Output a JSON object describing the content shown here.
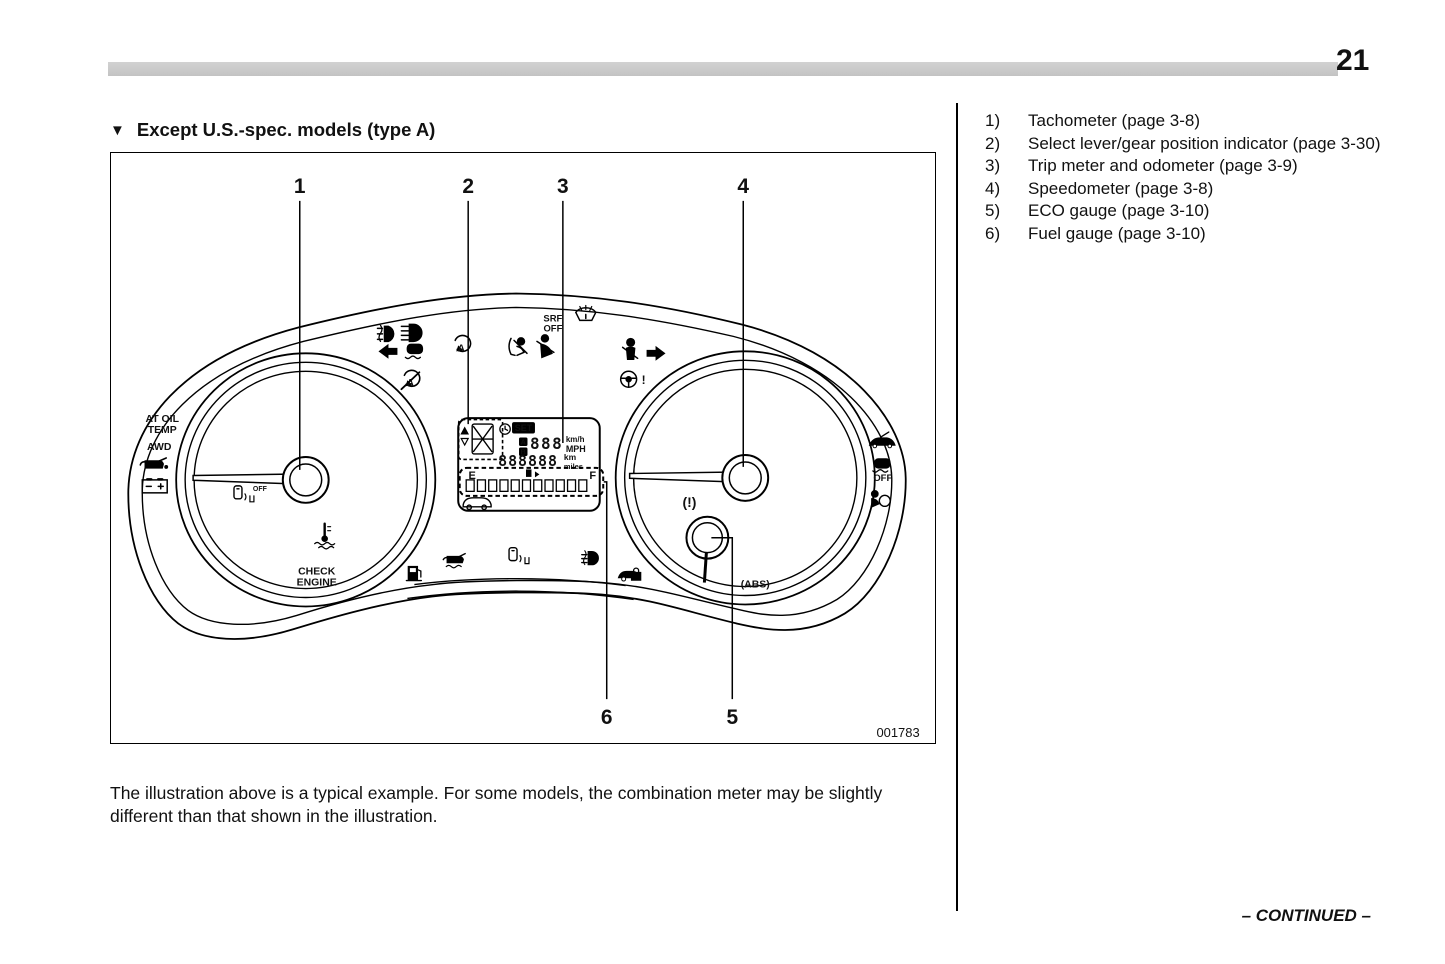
{
  "page": {
    "number": "21",
    "continued_label": "– CONTINUED –"
  },
  "heading": {
    "marker": "▼",
    "title": "Except U.S.-spec. models (type A)"
  },
  "legend": {
    "items": [
      {
        "num": "1)",
        "label": "Tachometer (page 3-8)"
      },
      {
        "num": "2)",
        "label": "Select lever/gear position indicator (page 3-30)"
      },
      {
        "num": "3)",
        "label": "Trip meter and odometer (page 3-9)"
      },
      {
        "num": "4)",
        "label": "Speedometer (page 3-8)"
      },
      {
        "num": "5)",
        "label": "ECO gauge (page 3-10)"
      },
      {
        "num": "6)",
        "label": "Fuel gauge (page 3-10)"
      }
    ]
  },
  "figure": {
    "code": "001783",
    "caption": "The illustration above is a typical example. For some models, the combination meter may be slightly different than that shown in the illustration.",
    "callouts": {
      "c1": "1",
      "c2": "2",
      "c3": "3",
      "c4": "4",
      "c5": "5",
      "c6": "6"
    },
    "cluster_labels": {
      "at_oil": "AT OIL",
      "temp": "TEMP",
      "awd": "AWD",
      "srf": "SRF",
      "srf_off": "OFF",
      "vdc_off": "OFF",
      "key_off": "OFF",
      "check": "CHECK",
      "engine": "ENGINE",
      "brake_warning": "(!)",
      "abs": "(ABS)"
    },
    "lcd": {
      "set": "SET",
      "a": "A",
      "b": "B",
      "digits_speed": "888",
      "unit_kmh": "km/h",
      "unit_mph": "MPH",
      "digits_odo": "888888",
      "unit_km": "km",
      "unit_miles": "miles",
      "fuel_empty": "E",
      "fuel_full": "F"
    }
  }
}
